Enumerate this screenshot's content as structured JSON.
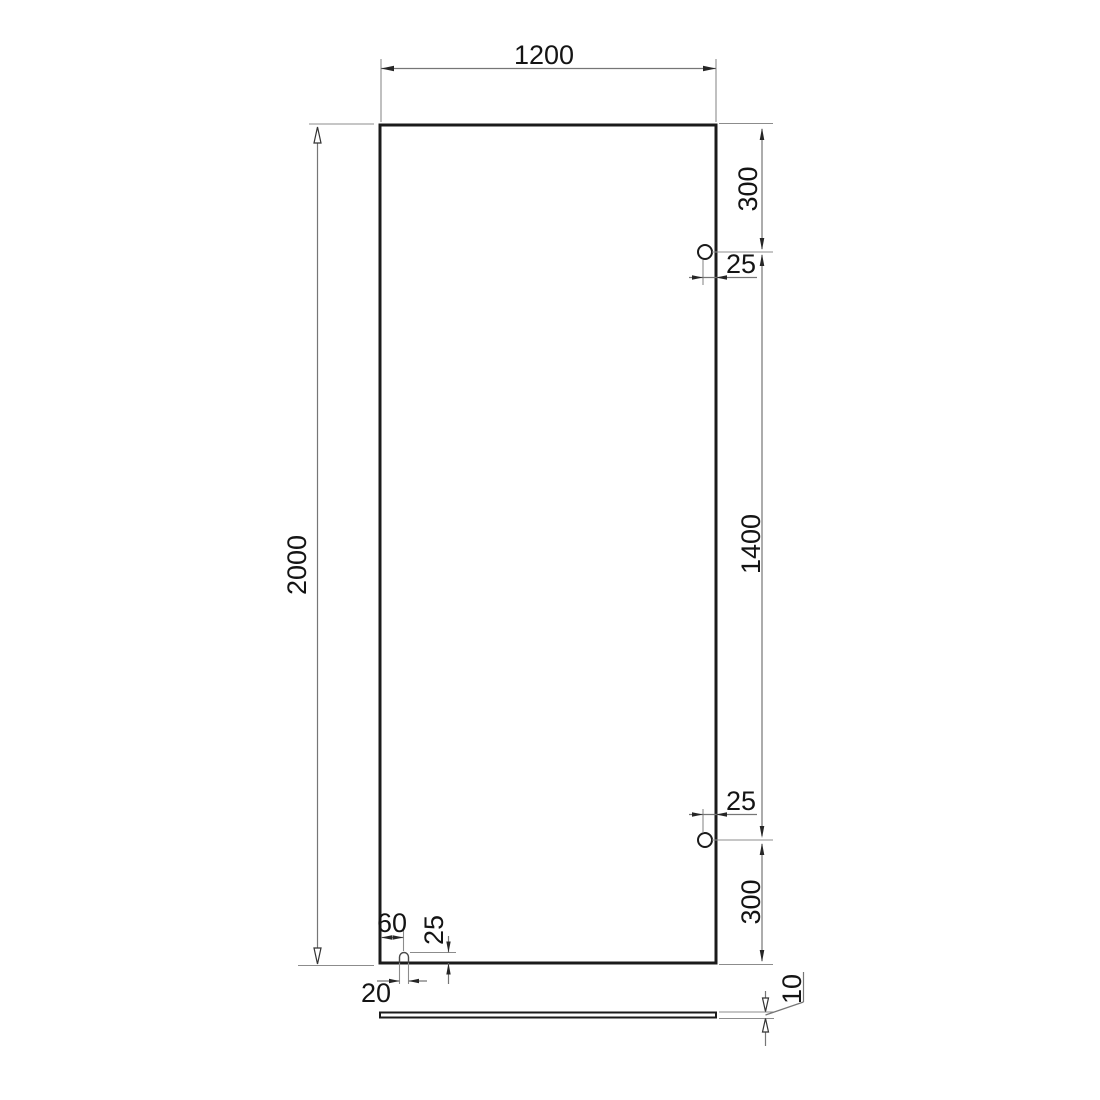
{
  "drawing": {
    "kind": "dimensioned panel drawing with two holes, bottom notch and thickness side view",
    "labels": {
      "panel_width": "1200",
      "panel_height": "2000",
      "hole_top_offset": "300",
      "hole_top_edge_distance": "25",
      "hole_spacing": "1400",
      "hole_bottom_edge_distance": "25",
      "hole_bottom_offset": "300",
      "notch_center_from_edge": "60",
      "notch_depth": "25",
      "notch_width": "20",
      "panel_thickness": "10"
    },
    "colors": {
      "outline": "#1b1b1b",
      "dimension_lines": "#767676",
      "extension_lines": "#8c8c8c",
      "text": "#141414",
      "background": "#ffffff"
    }
  }
}
